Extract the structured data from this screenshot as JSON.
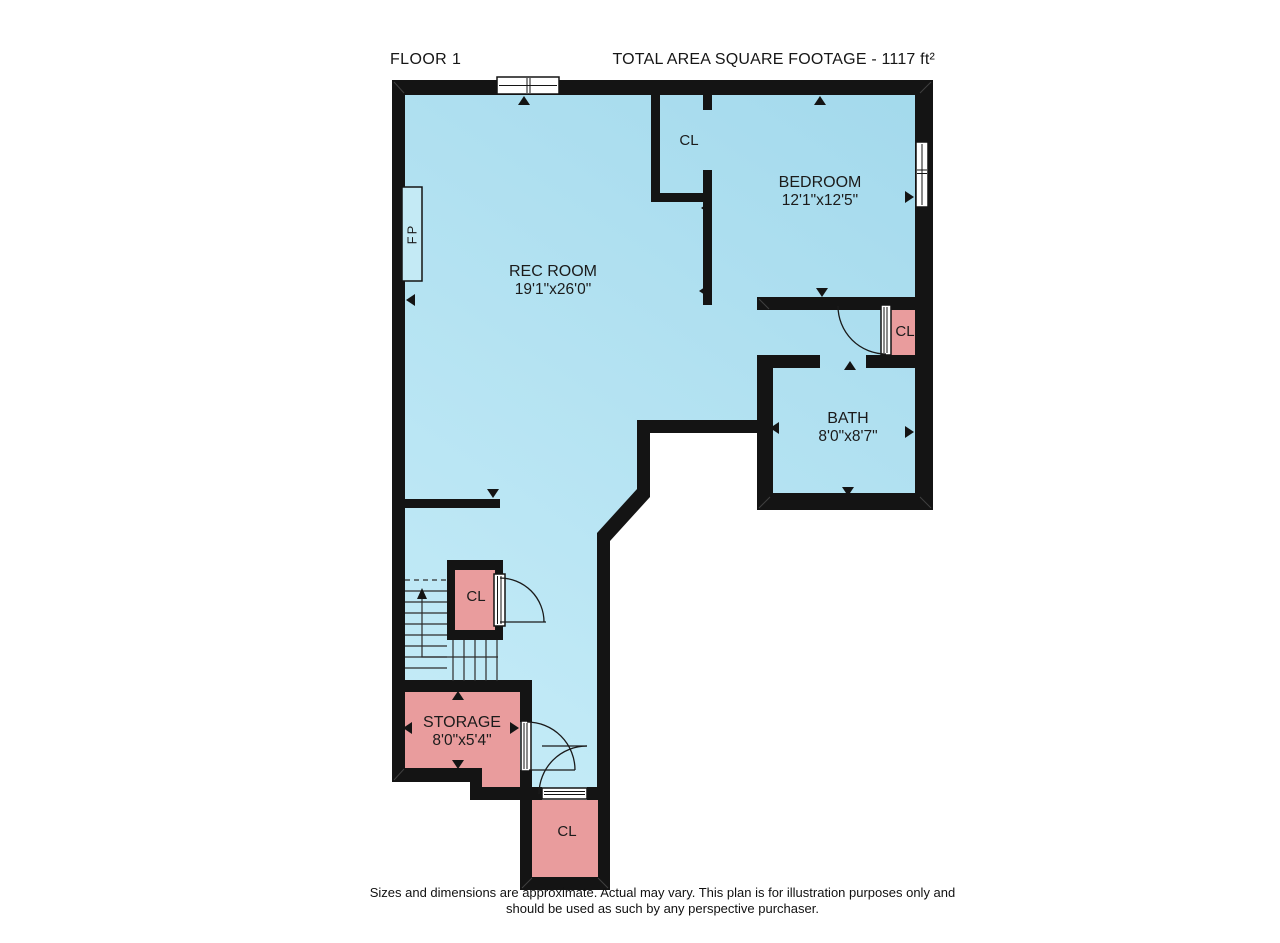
{
  "title": {
    "floor_label": "FLOOR 1",
    "total_area_label": "TOTAL AREA SQUARE FOOTAGE - 1117 ft²"
  },
  "rooms": {
    "rec_room": {
      "name": "REC ROOM",
      "dimensions": "19'1\"x26'0\""
    },
    "bedroom": {
      "name": "BEDROOM",
      "dimensions": "12'1\"x12'5\""
    },
    "bath": {
      "name": "BATH",
      "dimensions": "8'0\"x8'7\""
    },
    "storage": {
      "name": "STORAGE",
      "dimensions": "8'0\"x5'4\""
    },
    "closet_hall": {
      "name": "CL"
    },
    "closet_bath": {
      "name": "CL"
    },
    "closet_stairs": {
      "name": "CL"
    },
    "closet_entry": {
      "name": "CL"
    },
    "fireplace": {
      "name": "FP"
    }
  },
  "disclaimer": {
    "line1": "Sizes and dimensions are approximate. Actual may vary. This plan is for illustration purposes only and",
    "line2": "should be used as such by any perspective purchaser."
  },
  "colors": {
    "floor-dark": "#a3d9ec",
    "floor-light": "#c9eef9",
    "room-pink": "#e99c9d",
    "wall": "#141414"
  }
}
